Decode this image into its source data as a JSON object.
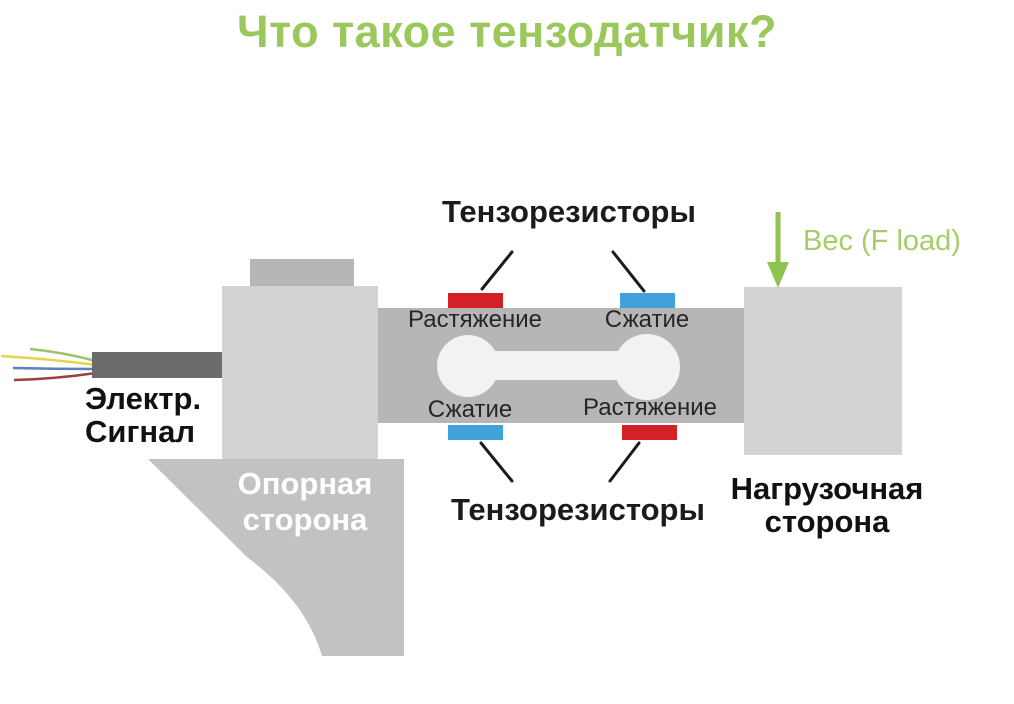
{
  "title": "Что такое тензодатчик?",
  "diagram": {
    "strain_gauges_top": "Тензорезисторы",
    "strain_gauges_bottom": "Тензорезисторы",
    "gauge_top_left": "Растяжение",
    "gauge_top_right": "Сжатие",
    "gauge_bottom_left": "Сжатие",
    "gauge_bottom_right": "Растяжение",
    "electric_signal": {
      "line1": "Электр.",
      "line2": "Сигнал"
    },
    "support_side": {
      "line1": "Опорная",
      "line2": "сторона"
    },
    "load_side": {
      "line1": "Нагрузочная",
      "line2": "сторона"
    },
    "weight": "Вес (F load)"
  },
  "colors": {
    "title_green": "#9bc85c",
    "arrow_green": "#90c24f",
    "weight_text_green": "#a6cd6b",
    "gauge_red": "#d32127",
    "gauge_blue": "#41a2da",
    "beam_gray": "#b6b6b6",
    "block_light_gray": "#d3d3d3",
    "boss_gray": "#b6b6b6",
    "pedestal_gray": "#c2c2c2",
    "cable_dark_gray": "#6b6b6b",
    "cutout_white": "#f2f2f2",
    "wire_green": "#9cc46a",
    "wire_yellow": "#e6d34f",
    "wire_blue": "#5b7fc0",
    "wire_maroon": "#9a4040",
    "pointer_black": "#1b1b1b",
    "text_black": "#111111",
    "text_white": "#ffffff"
  }
}
